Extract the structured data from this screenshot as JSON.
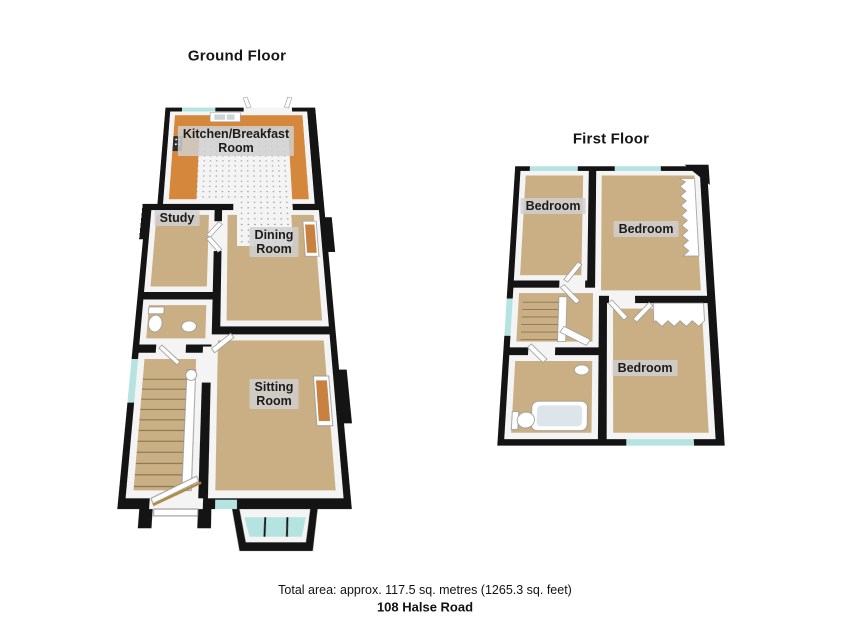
{
  "titles": {
    "ground_floor": "Ground Floor",
    "first_floor": "First Floor"
  },
  "rooms": {
    "kitchen": "Kitchen/Breakfast\nRoom",
    "study": "Study",
    "dining": "Dining\nRoom",
    "sitting": "Sitting\nRoom",
    "bedroom_front": "Bedroom",
    "bedroom_middle": "Bedroom",
    "bedroom_rear": "Bedroom"
  },
  "footer": {
    "total_area": "Total area: approx. 117.5 sq. metres (1265.3 sq. feet)",
    "address": "108 Halse Road"
  },
  "colors": {
    "wall": "#141414",
    "innerWall": "#f4f4f4",
    "carpet": "#c9af83",
    "kitchenFloor": "#d5873b",
    "tile": "#f4f4f4",
    "tileDot": "#999999",
    "windowGlass": "#b5e3e0",
    "fixture": "#ffffff",
    "fireplace": "#c8813f",
    "counter": "#b3a59c",
    "stairLine": "#8c7b55",
    "doorSwing": "#b08a3e",
    "labelBg": "rgba(208,208,208,0.85)",
    "labelText": "#1c1c1c"
  }
}
